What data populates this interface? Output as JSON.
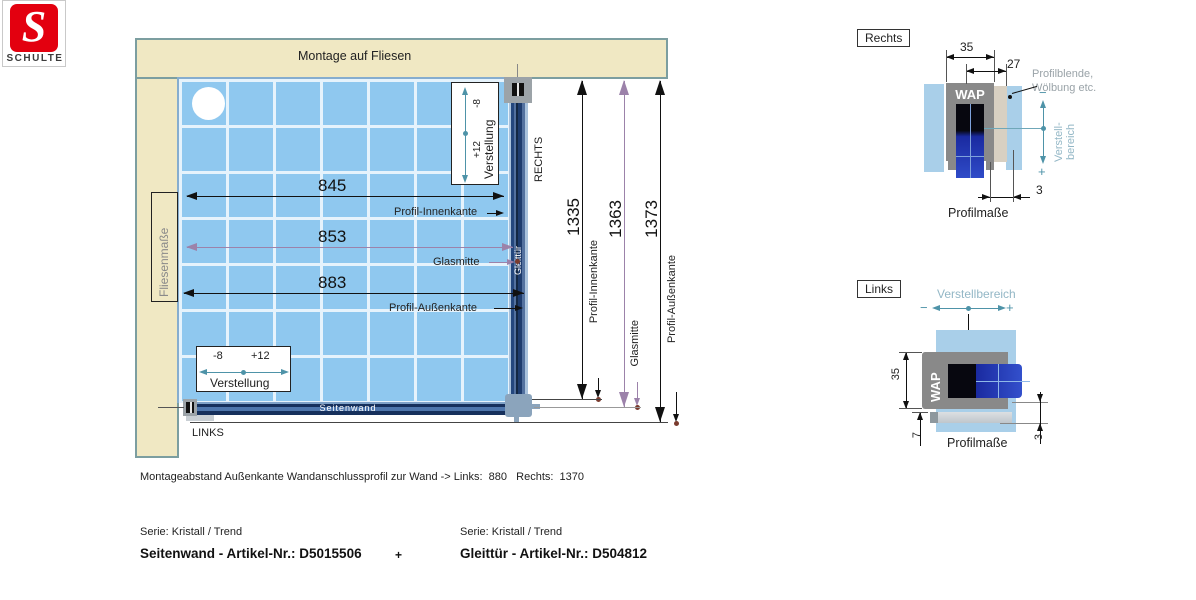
{
  "logo": {
    "brand": "SCHULTE",
    "brand_color": "#E3000F"
  },
  "main": {
    "montage_label": "Montage auf Fliesen",
    "fliesen_label": "Fliesenmaße",
    "rechts": "RECHTS",
    "links": "LINKS",
    "seitenwand": "Seitenwand",
    "gleittuer": "Gleittür",
    "dim_845": "845",
    "dim_853": "853",
    "dim_883": "883",
    "dim_1335": "1335",
    "dim_1363": "1363",
    "dim_1373": "1373",
    "lbl_innenkante": "Profil-Innenkante",
    "lbl_glasmitte": "Glasmitte",
    "lbl_aussenkante": "Profil-Außenkante",
    "verstellung": {
      "label": "Verstellung",
      "minus": "-8",
      "plus": "+12"
    },
    "colors": {
      "tile": "#8FC8EF",
      "wall": "#F0E8C3",
      "profile": "#1E3C6E",
      "purple": "#9C82AA",
      "teal": "#4E93A8"
    }
  },
  "detail_rechts": {
    "title": "Rechts",
    "dim35": "35",
    "dim27": "27",
    "dim3": "3",
    "wap": "WAP",
    "note1": "Profilblende,",
    "note2": "Wölbung etc.",
    "verstell1": "Verstell-",
    "verstell2": "bereich",
    "minus": "−",
    "plus": "+",
    "caption": "Profilmaße"
  },
  "detail_links": {
    "title": "Links",
    "verstellbereich": "Verstellbereich",
    "wap": "WAP",
    "dim35": "35",
    "dim7": "7",
    "dim3": "3",
    "minus": "−",
    "plus": "+",
    "caption": "Profilmaße"
  },
  "footer": {
    "note": "Montageabstand Außenkante Wandanschlussprofil zur Wand -> Links:  880   Rechts:  1370",
    "serie_left": "Serie: Kristall / Trend",
    "serie_right": "Serie: Kristall / Trend",
    "artikel_left": "Seitenwand - Artikel-Nr.: D5015506",
    "plus": "+",
    "artikel_right": "Gleittür - Artikel-Nr.: D504812"
  }
}
